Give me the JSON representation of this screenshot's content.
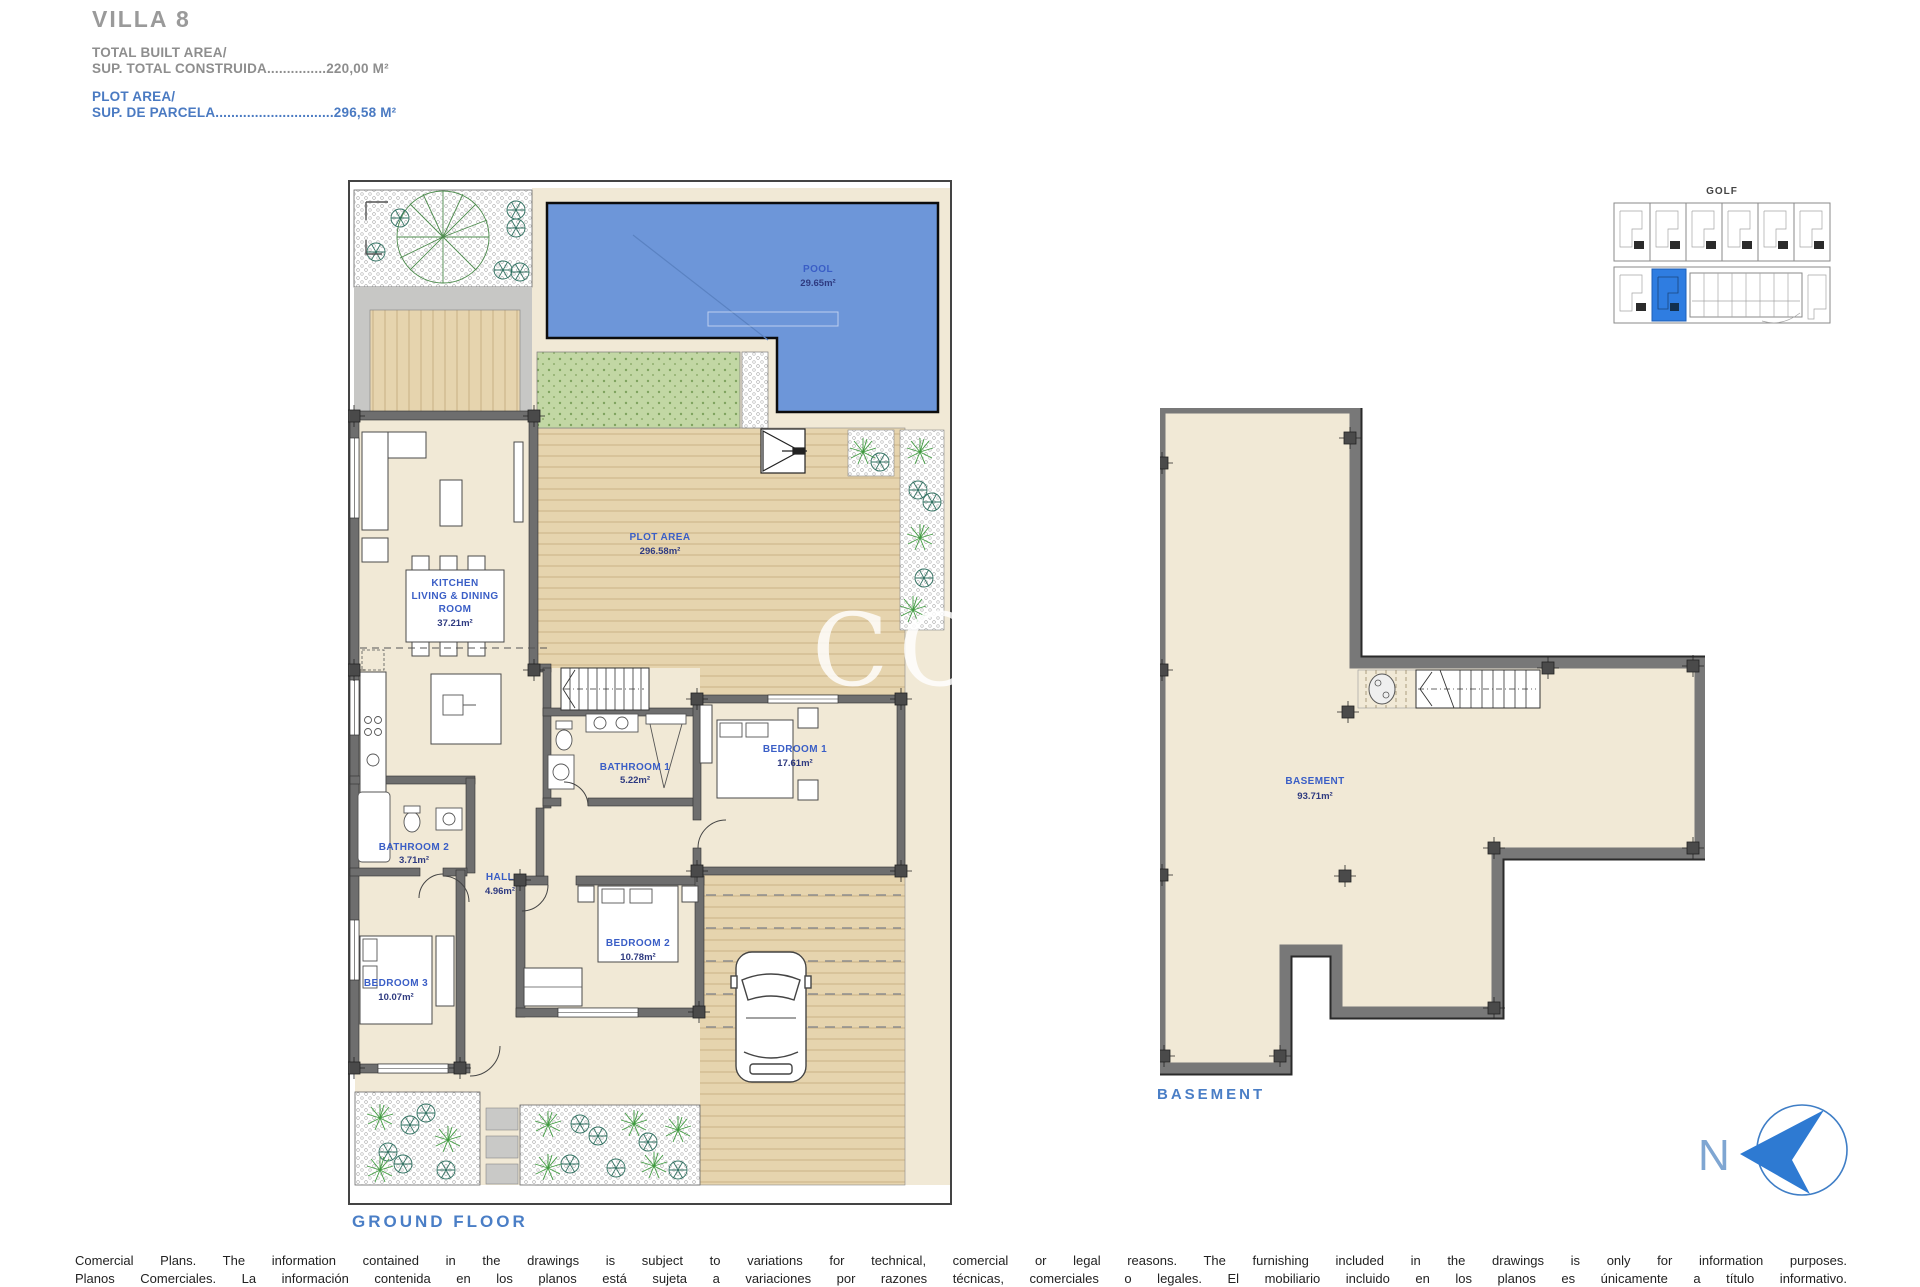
{
  "header": {
    "title": "VILLA 8",
    "built_area_label": "TOTAL BUILT AREA/",
    "built_area_line": "SUP. TOTAL CONSTRUIDA...............220,00 M²",
    "plot_area_label": "PLOT AREA/",
    "plot_area_line": "SUP. DE PARCELA..............................296,58 M²"
  },
  "ground_floor": {
    "caption": "GROUND FLOOR",
    "pool": {
      "name": "POOL",
      "area": "29.65m²"
    },
    "plot": {
      "name": "PLOT AREA",
      "area": "296.58m²"
    },
    "kitchen": {
      "line1": "KITCHEN",
      "line2": "LIVING & DINING",
      "line3": "ROOM",
      "area": "37.21m²"
    },
    "bathroom1": {
      "name": "BATHROOM 1",
      "area": "5.22m²"
    },
    "bedroom1": {
      "name": "BEDROOM 1",
      "area": "17.61m²"
    },
    "bathroom2": {
      "name": "BATHROOM 2",
      "area": "3.71m²"
    },
    "hall": {
      "name": "HALL",
      "area": "4.96m²"
    },
    "bedroom2": {
      "name": "BEDROOM 2",
      "area": "10.78m²"
    },
    "bedroom3": {
      "name": "BEDROOM 3",
      "area": "10.07m²"
    }
  },
  "basement": {
    "caption": "BASEMENT",
    "room": {
      "name": "BASEMENT",
      "area": "93.71m²"
    }
  },
  "locator": {
    "title": "GOLF"
  },
  "compass": {
    "north_label": "N"
  },
  "watermark": "COST",
  "disclaimer": {
    "line1": "Comercial Plans. The information contained in the drawings is subject to variations for technical, comercial or legal reasons. The furnishing included in the drawings is only for information purposes.",
    "line2": "Planos Comerciales. La información contenida en los planos está sujeta a variaciones por razones técnicas, comerciales o legales. El mobiliario incluido en los planos es únicamente a título informativo."
  },
  "colors": {
    "label_blue": "#3a5ec6",
    "header_blue": "#4a7ac2",
    "title_gray": "#9a9a9a",
    "pool_blue": "#6d96d9",
    "wall_gray": "#6e6e6e",
    "wood_tan": "#e6d4ae",
    "lawn_green": "#c2d7a4",
    "locator_highlight_blue": "#2f7de1"
  }
}
